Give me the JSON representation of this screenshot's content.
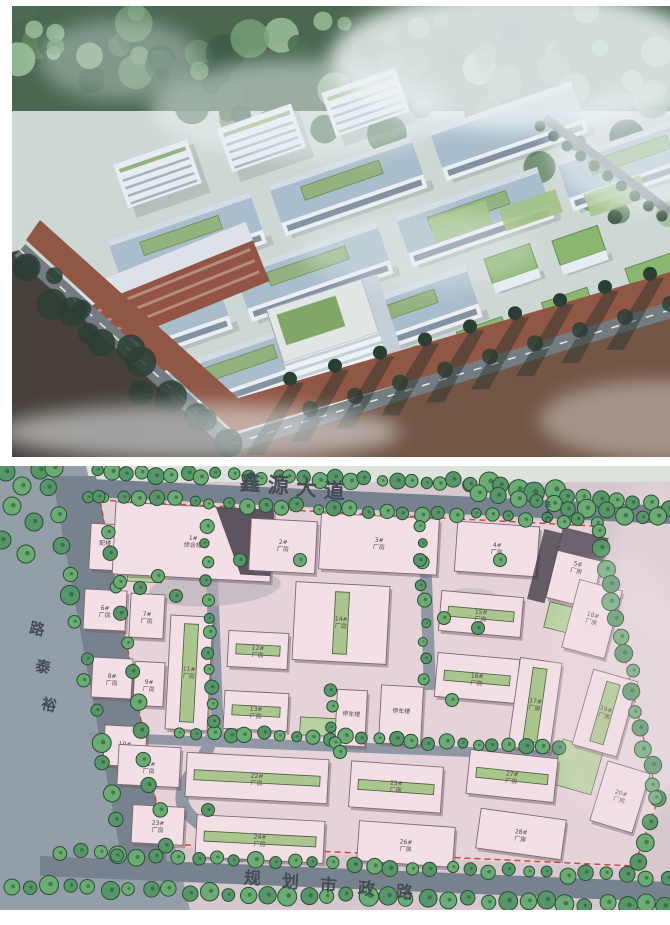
{
  "site_plan": {
    "road_labels": {
      "top": "鑫源大道",
      "left": "裕泰路",
      "bottom": "规划市政路"
    },
    "entrance_label": "主入口",
    "buildings": [
      {
        "label": "配楼",
        "x": 90,
        "y": 524,
        "w": 30,
        "h": 46,
        "r": 3
      },
      {
        "label": "1#综合楼",
        "x": 114,
        "y": 506,
        "w": 158,
        "h": 72,
        "r": 3,
        "dark": "right"
      },
      {
        "label": "2#厂房",
        "x": 250,
        "y": 520,
        "w": 66,
        "h": 52,
        "r": 3
      },
      {
        "label": "3#厂房",
        "x": 320,
        "y": 516,
        "w": 118,
        "h": 56,
        "r": 3
      },
      {
        "label": "4#厂房",
        "x": 456,
        "y": 524,
        "w": 82,
        "h": 50,
        "r": 4
      },
      {
        "label": "5#厂房",
        "x": 554,
        "y": 532,
        "w": 46,
        "h": 72,
        "r": 14,
        "dark": "left"
      },
      {
        "label": "6#厂房",
        "x": 84,
        "y": 590,
        "w": 42,
        "h": 40,
        "r": 3
      },
      {
        "label": "7#厂房",
        "x": 130,
        "y": 594,
        "w": 34,
        "h": 44,
        "r": 3
      },
      {
        "label": "8#厂房",
        "x": 92,
        "y": 658,
        "w": 40,
        "h": 40,
        "r": 3
      },
      {
        "label": "9#厂房",
        "x": 134,
        "y": 662,
        "w": 30,
        "h": 44,
        "r": 3
      },
      {
        "label": "10#厂房",
        "x": 104,
        "y": 726,
        "w": 42,
        "h": 40,
        "r": 3
      },
      {
        "label": "11#厂房",
        "x": 168,
        "y": 616,
        "w": 42,
        "h": 114,
        "r": 3,
        "roof": "gv"
      },
      {
        "label": "12#厂房",
        "x": 228,
        "y": 632,
        "w": 60,
        "h": 36,
        "r": 3,
        "roof": "gh"
      },
      {
        "label": "13#厂房",
        "x": 224,
        "y": 692,
        "w": 64,
        "h": 38,
        "r": 3,
        "roof": "gh"
      },
      {
        "label": "14#厂房",
        "x": 294,
        "y": 584,
        "w": 94,
        "h": 78,
        "r": 3,
        "roof": "gv"
      },
      {
        "label": "停车楼",
        "x": 336,
        "y": 690,
        "w": 30,
        "h": 56,
        "r": 3
      },
      {
        "label": "停车楼",
        "x": 380,
        "y": 686,
        "w": 42,
        "h": 58,
        "r": 3
      },
      {
        "label": "15#厂房",
        "x": 440,
        "y": 594,
        "w": 82,
        "h": 40,
        "r": 5,
        "roof": "gh"
      },
      {
        "label": "16#厂房",
        "x": 436,
        "y": 656,
        "w": 82,
        "h": 44,
        "r": 5,
        "roof": "gh"
      },
      {
        "label": "17#厂房",
        "x": 514,
        "y": 660,
        "w": 42,
        "h": 90,
        "r": 8,
        "roof": "gv"
      },
      {
        "label": "18#厂房",
        "x": 570,
        "y": 584,
        "w": 44,
        "h": 70,
        "r": 15
      },
      {
        "label": "19#厂房",
        "x": 582,
        "y": 674,
        "w": 46,
        "h": 78,
        "r": 16,
        "roof": "gv"
      },
      {
        "label": "20#厂房",
        "x": 598,
        "y": 766,
        "w": 44,
        "h": 62,
        "r": 17
      },
      {
        "label": "21#厂房",
        "x": 118,
        "y": 746,
        "w": 62,
        "h": 40,
        "r": 3
      },
      {
        "label": "22#厂房",
        "x": 186,
        "y": 756,
        "w": 142,
        "h": 44,
        "r": 3,
        "roof": "gh"
      },
      {
        "label": "23#厂房",
        "x": 132,
        "y": 806,
        "w": 52,
        "h": 38,
        "r": 3
      },
      {
        "label": "24#厂房",
        "x": 196,
        "y": 818,
        "w": 128,
        "h": 42,
        "r": 3,
        "roof": "gh"
      },
      {
        "label": "25#厂房",
        "x": 350,
        "y": 764,
        "w": 92,
        "h": 46,
        "r": 4,
        "roof": "gh"
      },
      {
        "label": "26#厂房",
        "x": 358,
        "y": 824,
        "w": 96,
        "h": 40,
        "r": 4
      },
      {
        "label": "27#厂房",
        "x": 468,
        "y": 754,
        "w": 88,
        "h": 44,
        "r": 6,
        "roof": "gh"
      },
      {
        "label": "28#厂房",
        "x": 478,
        "y": 814,
        "w": 86,
        "h": 40,
        "r": 8
      }
    ]
  },
  "palette": {
    "render": {
      "sky": "#cdd6d2",
      "forest_base": "#3f5d44",
      "forest_tones": [
        "#2e4f38",
        "#3f6347",
        "#547a56",
        "#6f9a70",
        "#8fb58b"
      ],
      "mist": "#eef3f4",
      "roof_blue": "#a7bac9",
      "roof_ridge": "#d3dce2",
      "roof_green": "#8fae77",
      "facade": "#edf0f3",
      "window_band": "#5f7184",
      "white_block": "#e8edf1",
      "cube_green": "#85b264",
      "cube_green_edge": "#5e8748",
      "brick": "#8c4836",
      "brick_roof": "#dde2e6",
      "tower_face_light": "#f1f4f6",
      "tower_face_shade": "#c3ced6",
      "tower_roof_green": "#79a25d",
      "tower_roof_deck": "#e2e7e4",
      "ground_brown": "#8a4b36",
      "ground_dark": "#3c332c",
      "ground_right": "#6b4a38",
      "road": "#6d7478",
      "road_line": "#e8e8e8",
      "tree_dark": "#1d3024",
      "shadow": "#16231b",
      "lawn": "#9ec07c"
    },
    "plan": {
      "base": "#d6c6ce",
      "outside_left": "#8e99a5",
      "top_strip": "#dfe4de",
      "site_fill": "#e6d2d8",
      "road": "#717b89",
      "road_inner": "#8a93a0",
      "tree_fill": "#4e9160",
      "tree_fill2": "#63a86e",
      "tree_stroke": "#1f4429",
      "building_fill": "#f4dfe5",
      "building_stroke": "#77606b",
      "building_shadow": "#6a5560",
      "building_dark": "#413a47",
      "green_roof": "#a6c488",
      "green_roof_stroke": "#3c5532",
      "lawn": "#b4cf9c",
      "boundary_red": "#c53227",
      "road_text": "#39424e",
      "label_text": "#4a3a44",
      "plaza": "#b7aeb8"
    }
  }
}
